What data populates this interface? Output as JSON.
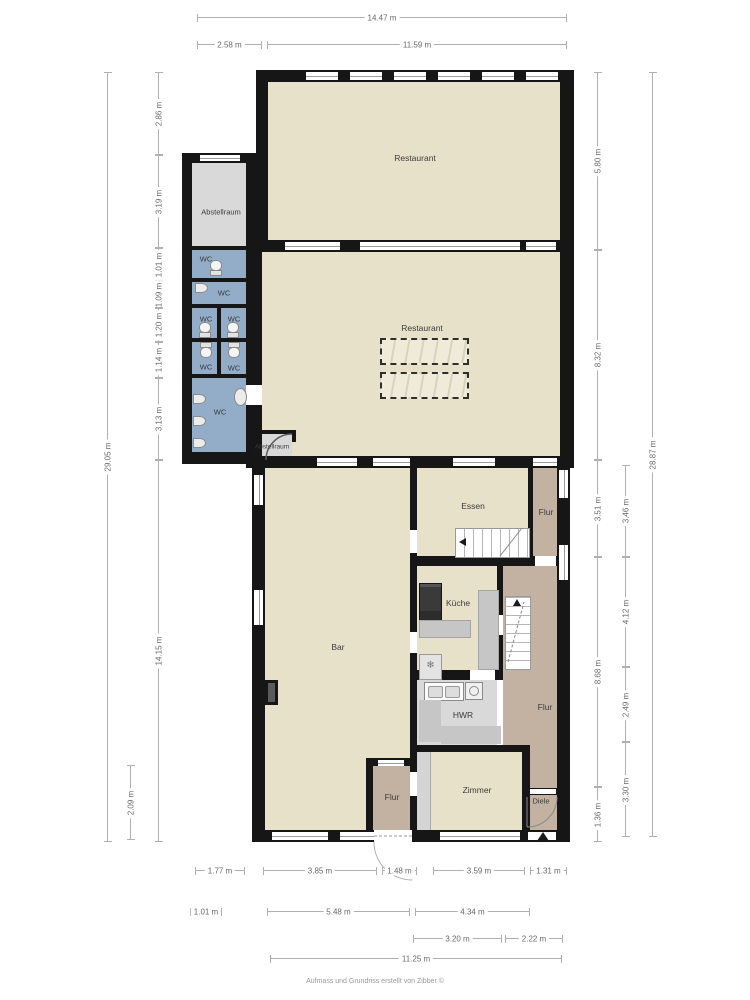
{
  "footer": "Aufmass und Grundriss erstellt von Zibber ©",
  "colors": {
    "wall": "#161616",
    "room_beige": "#e8e1c9",
    "room_gray": "#d9d9d9",
    "room_blue": "#93acc8",
    "room_brown": "#c3b2a2",
    "dimension_line": "#b0b0b0",
    "dimension_text": "#6a6a6a"
  },
  "room_labels": [
    {
      "id": "restaurant-upper",
      "t": "Restaurant",
      "x": 415,
      "y": 158,
      "s": 8.5
    },
    {
      "id": "abstellraum-1",
      "t": "Abstellraum",
      "x": 221,
      "y": 212,
      "s": 7.5
    },
    {
      "id": "wc-1",
      "t": "WC",
      "x": 206,
      "y": 259,
      "s": 7.5
    },
    {
      "id": "wc-2",
      "t": "WC",
      "x": 224,
      "y": 293,
      "s": 7.5
    },
    {
      "id": "wc-3",
      "t": "WC",
      "x": 206,
      "y": 319,
      "s": 7.5
    },
    {
      "id": "wc-4",
      "t": "WC",
      "x": 234,
      "y": 319,
      "s": 7.5
    },
    {
      "id": "wc-5",
      "t": "WC",
      "x": 206,
      "y": 367,
      "s": 7.5
    },
    {
      "id": "wc-6",
      "t": "WC",
      "x": 234,
      "y": 368,
      "s": 7.5
    },
    {
      "id": "wc-7",
      "t": "WC",
      "x": 220,
      "y": 412,
      "s": 7.5
    },
    {
      "id": "restaurant-middle",
      "t": "Restaurant",
      "x": 422,
      "y": 328,
      "s": 8.5
    },
    {
      "id": "abstellraum-2",
      "t": "Abstellraum",
      "x": 272,
      "y": 447,
      "s": 6.5
    },
    {
      "id": "essen",
      "t": "Essen",
      "x": 473,
      "y": 506,
      "s": 8.5
    },
    {
      "id": "flur-1",
      "t": "Flur",
      "x": 546,
      "y": 512,
      "s": 8.5
    },
    {
      "id": "kueche",
      "t": "Küche",
      "x": 458,
      "y": 603,
      "s": 8.5
    },
    {
      "id": "bar",
      "t": "Bar",
      "x": 338,
      "y": 647,
      "s": 8.5
    },
    {
      "id": "hwr",
      "t": "HWR",
      "x": 463,
      "y": 715,
      "s": 8.5
    },
    {
      "id": "flur-2",
      "t": "Flur",
      "x": 545,
      "y": 707,
      "s": 8.5
    },
    {
      "id": "zimmer",
      "t": "Zimmer",
      "x": 477,
      "y": 790,
      "s": 8.5
    },
    {
      "id": "flur-3",
      "t": "Flur",
      "x": 392,
      "y": 797,
      "s": 8.5
    },
    {
      "id": "diele",
      "t": "Diele",
      "x": 541,
      "y": 801,
      "s": 7.5
    }
  ],
  "dimensions": [
    {
      "t": "14.47 m",
      "o": "h",
      "x": 197,
      "y": 17,
      "len": 370
    },
    {
      "t": "2.58 m",
      "o": "h",
      "x": 197,
      "y": 44,
      "len": 65
    },
    {
      "t": "11.59 m",
      "o": "h",
      "x": 267,
      "y": 44,
      "len": 300
    },
    {
      "t": "1.77 m",
      "o": "h",
      "x": 195,
      "y": 870,
      "len": 50
    },
    {
      "t": "3.85 m",
      "o": "h",
      "x": 263,
      "y": 870,
      "len": 114
    },
    {
      "t": "1.48 m",
      "o": "h",
      "x": 382,
      "y": 870,
      "len": 35
    },
    {
      "t": "3.59 m",
      "o": "h",
      "x": 433,
      "y": 870,
      "len": 92
    },
    {
      "t": "1.31 m",
      "o": "h",
      "x": 530,
      "y": 870,
      "len": 37
    },
    {
      "t": "1.01 m",
      "o": "h",
      "x": 190,
      "y": 911,
      "len": 32
    },
    {
      "t": "5.48 m",
      "o": "h",
      "x": 267,
      "y": 911,
      "len": 143
    },
    {
      "t": "4.34 m",
      "o": "h",
      "x": 415,
      "y": 911,
      "len": 115
    },
    {
      "t": "3.20 m",
      "o": "h",
      "x": 413,
      "y": 938,
      "len": 89
    },
    {
      "t": "2.22 m",
      "o": "h",
      "x": 505,
      "y": 938,
      "len": 58
    },
    {
      "t": "11.25 m",
      "o": "h",
      "x": 270,
      "y": 958,
      "len": 292
    },
    {
      "t": "29.05 m",
      "o": "v",
      "x": 107,
      "y": 72,
      "len": 770
    },
    {
      "t": "2.86 m",
      "o": "v",
      "x": 158,
      "y": 72,
      "len": 83
    },
    {
      "t": "3.19 m",
      "o": "v",
      "x": 158,
      "y": 155,
      "len": 93
    },
    {
      "t": "1.01 m",
      "o": "v",
      "x": 158,
      "y": 248,
      "len": 33
    },
    {
      "t": "1.09 m",
      "o": "v",
      "x": 158,
      "y": 281,
      "len": 27
    },
    {
      "t": "1.20 m",
      "o": "v",
      "x": 158,
      "y": 308,
      "len": 34
    },
    {
      "t": "1.14 m",
      "o": "v",
      "x": 158,
      "y": 342,
      "len": 36
    },
    {
      "t": "3.13 m",
      "o": "v",
      "x": 158,
      "y": 378,
      "len": 82
    },
    {
      "t": "14.15 m",
      "o": "v",
      "x": 158,
      "y": 460,
      "len": 382
    },
    {
      "t": "2.09 m",
      "o": "v",
      "x": 130,
      "y": 765,
      "len": 75
    },
    {
      "t": "5.80 m",
      "o": "v",
      "x": 597,
      "y": 72,
      "len": 178
    },
    {
      "t": "8.32 m",
      "o": "v",
      "x": 597,
      "y": 250,
      "len": 210
    },
    {
      "t": "3.51 m",
      "o": "v",
      "x": 597,
      "y": 460,
      "len": 97
    },
    {
      "t": "8.68 m",
      "o": "v",
      "x": 597,
      "y": 557,
      "len": 230
    },
    {
      "t": "1.36 m",
      "o": "v",
      "x": 597,
      "y": 787,
      "len": 55
    },
    {
      "t": "3.46 m",
      "o": "v",
      "x": 625,
      "y": 465,
      "len": 92
    },
    {
      "t": "4.12 m",
      "o": "v",
      "x": 625,
      "y": 557,
      "len": 110
    },
    {
      "t": "2.49 m",
      "o": "v",
      "x": 625,
      "y": 667,
      "len": 75
    },
    {
      "t": "3.30 m",
      "o": "v",
      "x": 625,
      "y": 742,
      "len": 95
    },
    {
      "t": "28.87 m",
      "o": "v",
      "x": 652,
      "y": 72,
      "len": 765
    }
  ]
}
